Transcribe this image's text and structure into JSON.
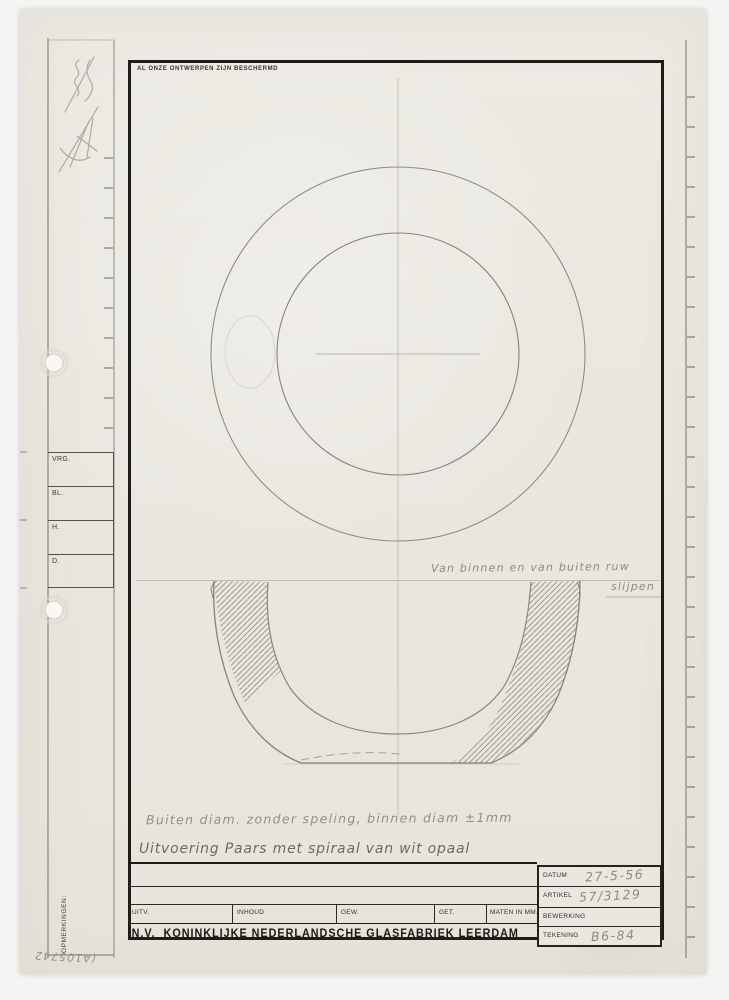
{
  "notices": {
    "protection": "AL ONZE ONTWERPEN ZIJN BESCHERMD"
  },
  "left_margin": {
    "fields": [
      {
        "label": "VRG."
      },
      {
        "label": "BL."
      },
      {
        "label": "H."
      },
      {
        "label": "D."
      }
    ],
    "remarks_label": "OPMERKINGEN:",
    "corner_stamp": "(A105742"
  },
  "annotations": {
    "grinding_note_line1": "Van binnen en van buiten ruw",
    "grinding_note_line2": "slijpen",
    "tolerance_note": "Buiten diam. zonder speling, binnen diam ±1mm",
    "execution_note": "Uitvoering Paars met spiraal van wit opaal"
  },
  "title_block": {
    "company": "N.V.  KONINKLIJKE NEDERLANDSCHE GLASFABRIEK LEERDAM",
    "columns": [
      "UITV.",
      "INHOUD",
      "GEW.",
      "GET.",
      "MATEN IN MM."
    ],
    "fields": [
      {
        "label": "DATUM",
        "value": "27-5-56"
      },
      {
        "label": "ARTIKEL",
        "value": "57/3129"
      },
      {
        "label": "BEWERKING",
        "value": ""
      },
      {
        "label": "TEKENING",
        "value": "B6-84"
      }
    ]
  },
  "drawing": {
    "views": [
      "top-view-concentric-circles",
      "section-view-bowl-with-hatching"
    ],
    "units_note": "MATEN IN MM."
  },
  "colors": {
    "paper": "#e9e6df",
    "frame_ink": "#1d1c19",
    "pencil": "#8f8b80",
    "pencil_dark": "#6e6a61"
  }
}
